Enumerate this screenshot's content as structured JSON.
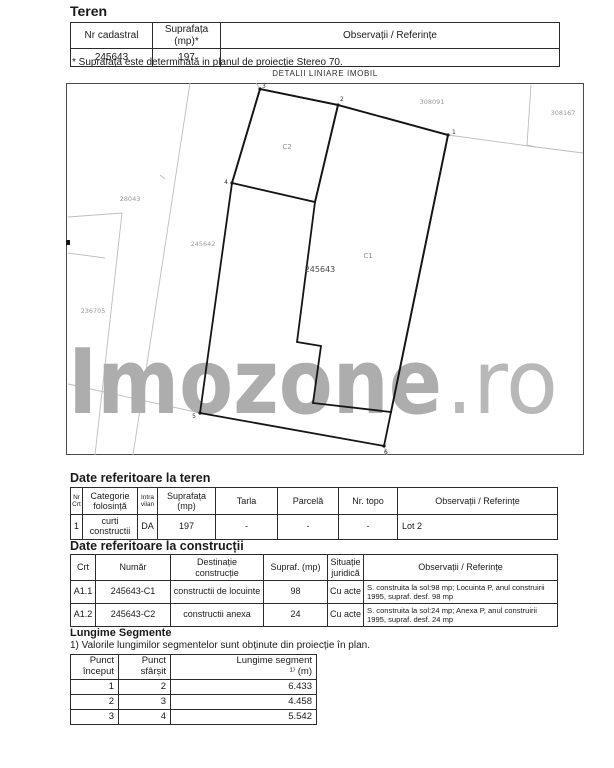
{
  "colors": {
    "watermark_main": "#adadad",
    "watermark_suffix": "#b8b8b8",
    "bold_parcel_line": "#151515",
    "faint_parcel_line": "#bdbdbd",
    "table_border": "#2b2b2b",
    "text": "#1a1a1a"
  },
  "teren": {
    "title": "Teren",
    "headers": [
      "Nr cadastral",
      "Suprafața (mp)*",
      "Observații / Referințe"
    ],
    "row": {
      "nr_cadastral": "245643",
      "suprafata": "197",
      "observatii": ""
    },
    "footnote": "* Suprafața este determinată in planul de proiecție Stereo 70."
  },
  "map": {
    "caption": "DETALII LINIARE IMOBIL",
    "watermark_main": "Imozone",
    "watermark_suffix": ".ro",
    "parcel_number": "245643",
    "building_c1": "C1",
    "building_c2": "C2",
    "neighbors": {
      "n308091": "308091",
      "n308167": "308167",
      "n28043": "28043",
      "n245642": "245642",
      "n236705": "236705"
    },
    "points": {
      "p1": "1",
      "p2": "2",
      "p3": "3",
      "p4": "4",
      "p5": "5",
      "p6": "6"
    }
  },
  "date_teren": {
    "title": "Date referitoare la teren",
    "headers": [
      "Nr\nCrt",
      "Categorie\nfolosință",
      "Intra\nvilan",
      "Suprafața\n(mp)",
      "Tarla",
      "Parcelă",
      "Nr. topo",
      "Observații / Referințe"
    ],
    "row": {
      "nr_crt": "1",
      "categorie": "curti constructii",
      "intravilan": "DA",
      "suprafata": "197",
      "tarla": "-",
      "parcela": "-",
      "nr_topo": "-",
      "observatii": "Lot 2"
    }
  },
  "date_constructii": {
    "title": "Date referitoare la construcții",
    "headers": [
      "Crt",
      "Număr",
      "Destinație\nconstrucție",
      "Supraf. (mp)",
      "Situație\njuridică",
      "Observații / Referințe"
    ],
    "rows": [
      {
        "crt": "A1.1",
        "numar": "245643-C1",
        "destinatie": "constructii de locuinte",
        "supraf": "98",
        "situatie": "Cu acte",
        "observatii": "S. construita la sol:98 mp;  Locuinta P, anul construirii 1995, supraf. desf. 98 mp"
      },
      {
        "crt": "A1.2",
        "numar": "245643-C2",
        "destinatie": "constructii anexa",
        "supraf": "24",
        "situatie": "Cu acte",
        "observatii": "S. construita la sol:24 mp;  Anexa P, anul construirii 1995, supraf. desf. 24 mp"
      }
    ]
  },
  "lungime_segmente": {
    "title": "Lungime Segmente",
    "note": "1) Valorile lungimilor segmentelor sunt obținute din proiecție în plan.",
    "headers": [
      "Punct\nînceput",
      "Punct\nsfârșit",
      "Lungime segment\n¹⁾ (m)"
    ],
    "rows": [
      {
        "start": "1",
        "end": "2",
        "len": "6.433"
      },
      {
        "start": "2",
        "end": "3",
        "len": "4.458"
      },
      {
        "start": "3",
        "end": "4",
        "len": "5.542"
      }
    ]
  }
}
